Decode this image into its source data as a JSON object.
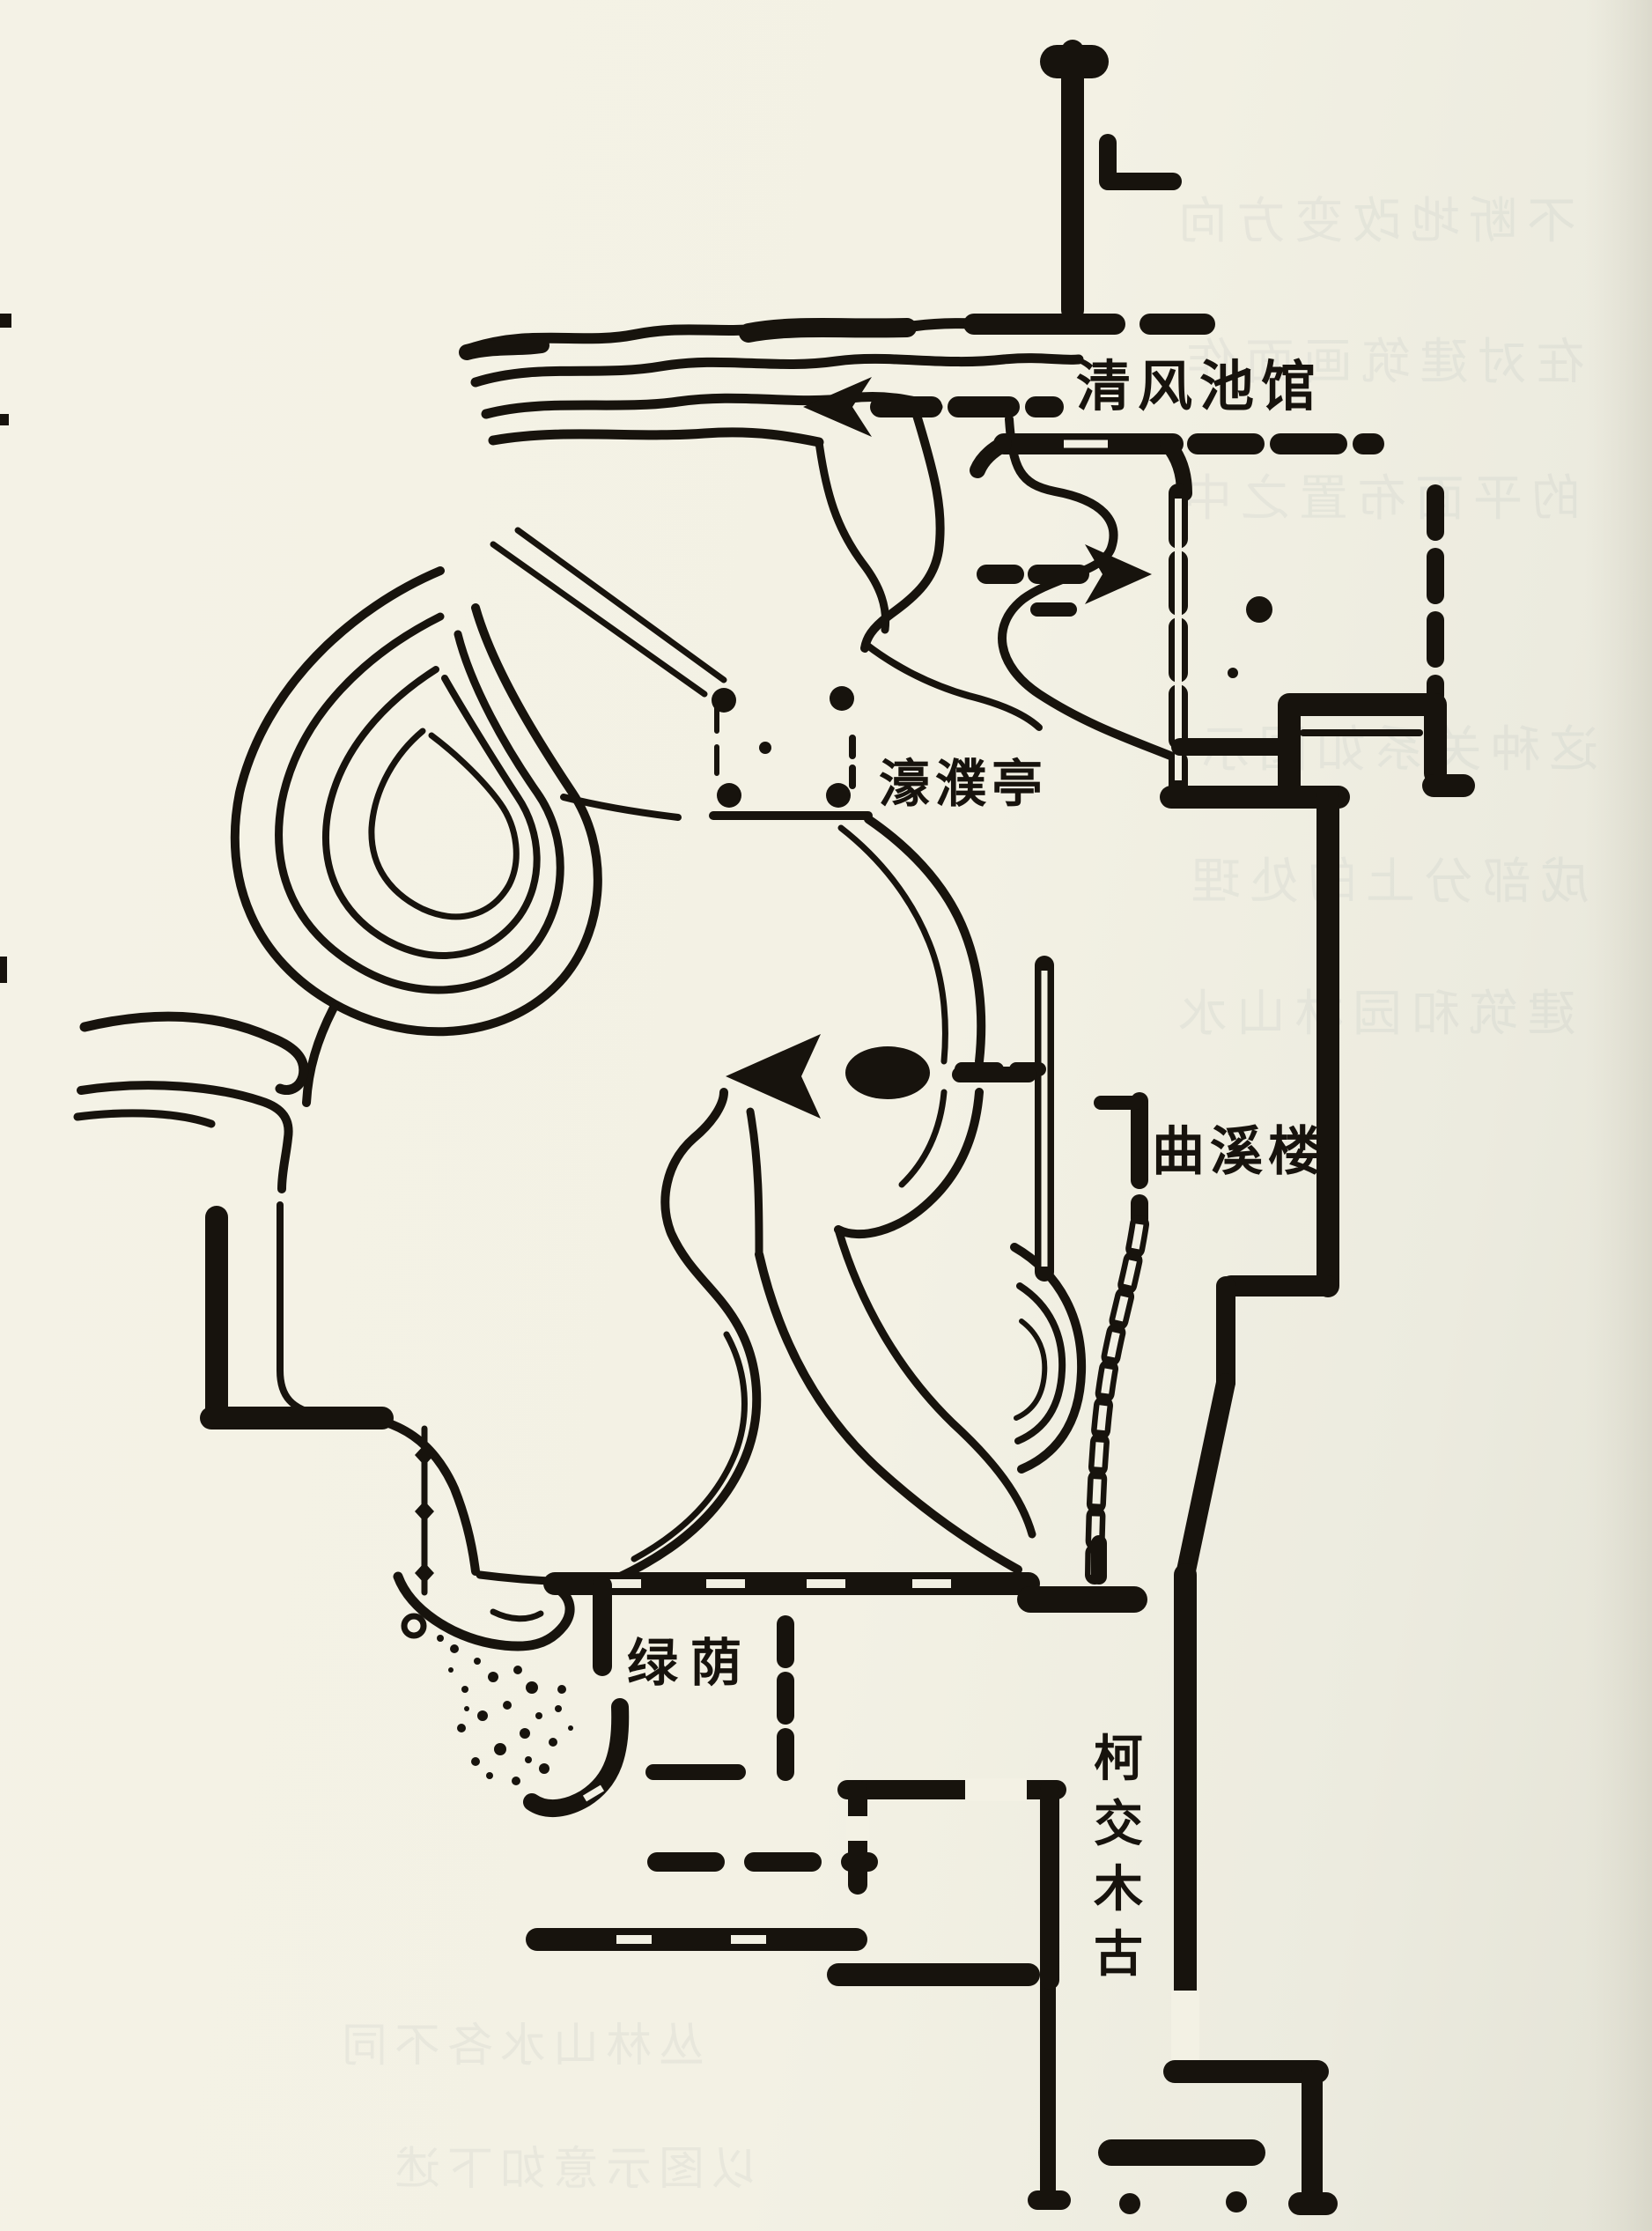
{
  "figure": {
    "type": "scanned garden plan line drawing (classical Chinese garden, central pond area)",
    "colors": {
      "paper": "#f3f1e4",
      "ink": "#17130d",
      "bleedthrough": "#7e8e98"
    },
    "labels": {
      "qingfeng": "清风池馆",
      "haopu": "濠濮亭",
      "quxi": "曲溪楼",
      "lvyin": "绿荫",
      "gumu": "古木交柯",
      "gumu_chars_top_to_bottom": [
        "柯",
        "交",
        "木",
        "古"
      ]
    },
    "bleedthrough_rows": [
      "不断地改变方向",
      "在对建筑画面作",
      "的平面布置之中",
      "这种关系如图示",
      "成部分上的处理",
      "建筑和园林山水",
      "丛林山水各不同",
      "以图示意如下述"
    ]
  }
}
